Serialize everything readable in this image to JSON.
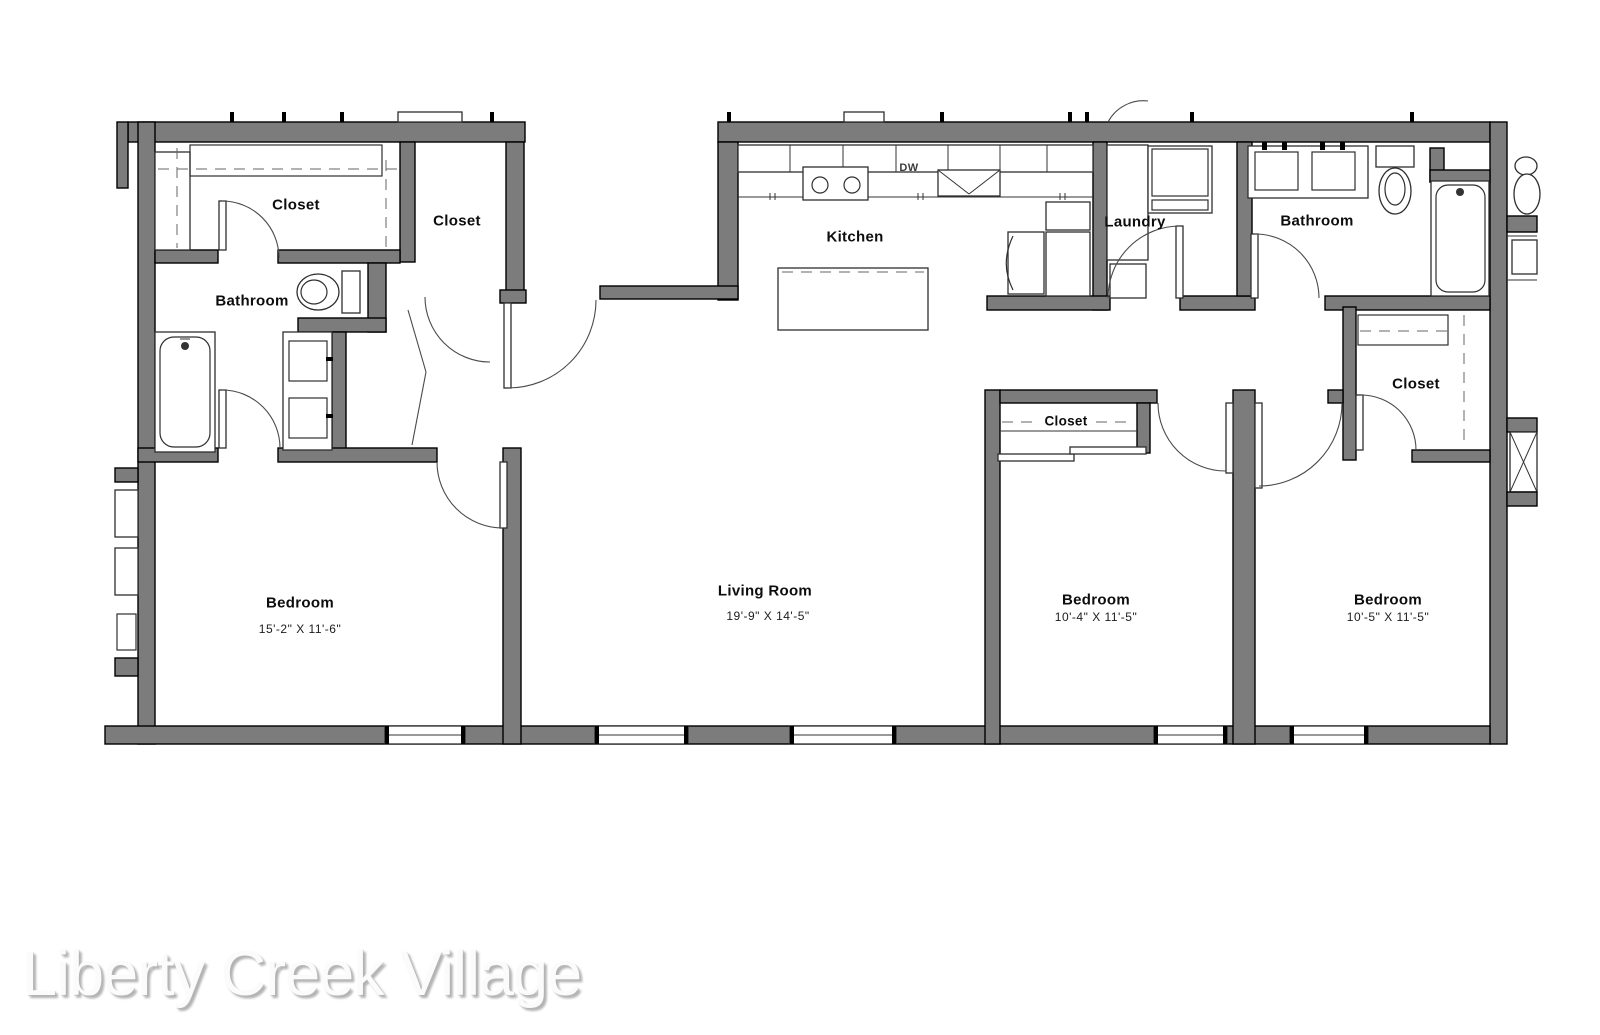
{
  "watermark": {
    "text": "Liberty Creek Village"
  },
  "rooms": {
    "walkin_closet": {
      "label": "Closet"
    },
    "entry_closet": {
      "label": "Closet"
    },
    "bathroom1": {
      "label": "Bathroom"
    },
    "kitchen": {
      "label": "Kitchen"
    },
    "laundry": {
      "label": "Laundry"
    },
    "bathroom2": {
      "label": "Bathroom"
    },
    "bedroom2_closet": {
      "label": "Closet"
    },
    "bedroom3_closet": {
      "label": "Closet"
    },
    "bedroom1": {
      "label": "Bedroom",
      "dims": "15'-2\" X 11'-6\""
    },
    "living_room": {
      "label": "Living Room",
      "dims": "19'-9\" X 14'-5\""
    },
    "bedroom2": {
      "label": "Bedroom",
      "dims": "10'-4\" X 11'-5\""
    },
    "bedroom3": {
      "label": "Bedroom",
      "dims": "10'-5\" X 11'-5\""
    }
  },
  "appliances": {
    "dishwasher_label": "DW"
  },
  "colors": {
    "wall_fill": "#7c7c7c",
    "wall_stroke": "#000000",
    "fixture_stroke": "#2e2e2e",
    "watermark_color": "#fbfbfb"
  }
}
